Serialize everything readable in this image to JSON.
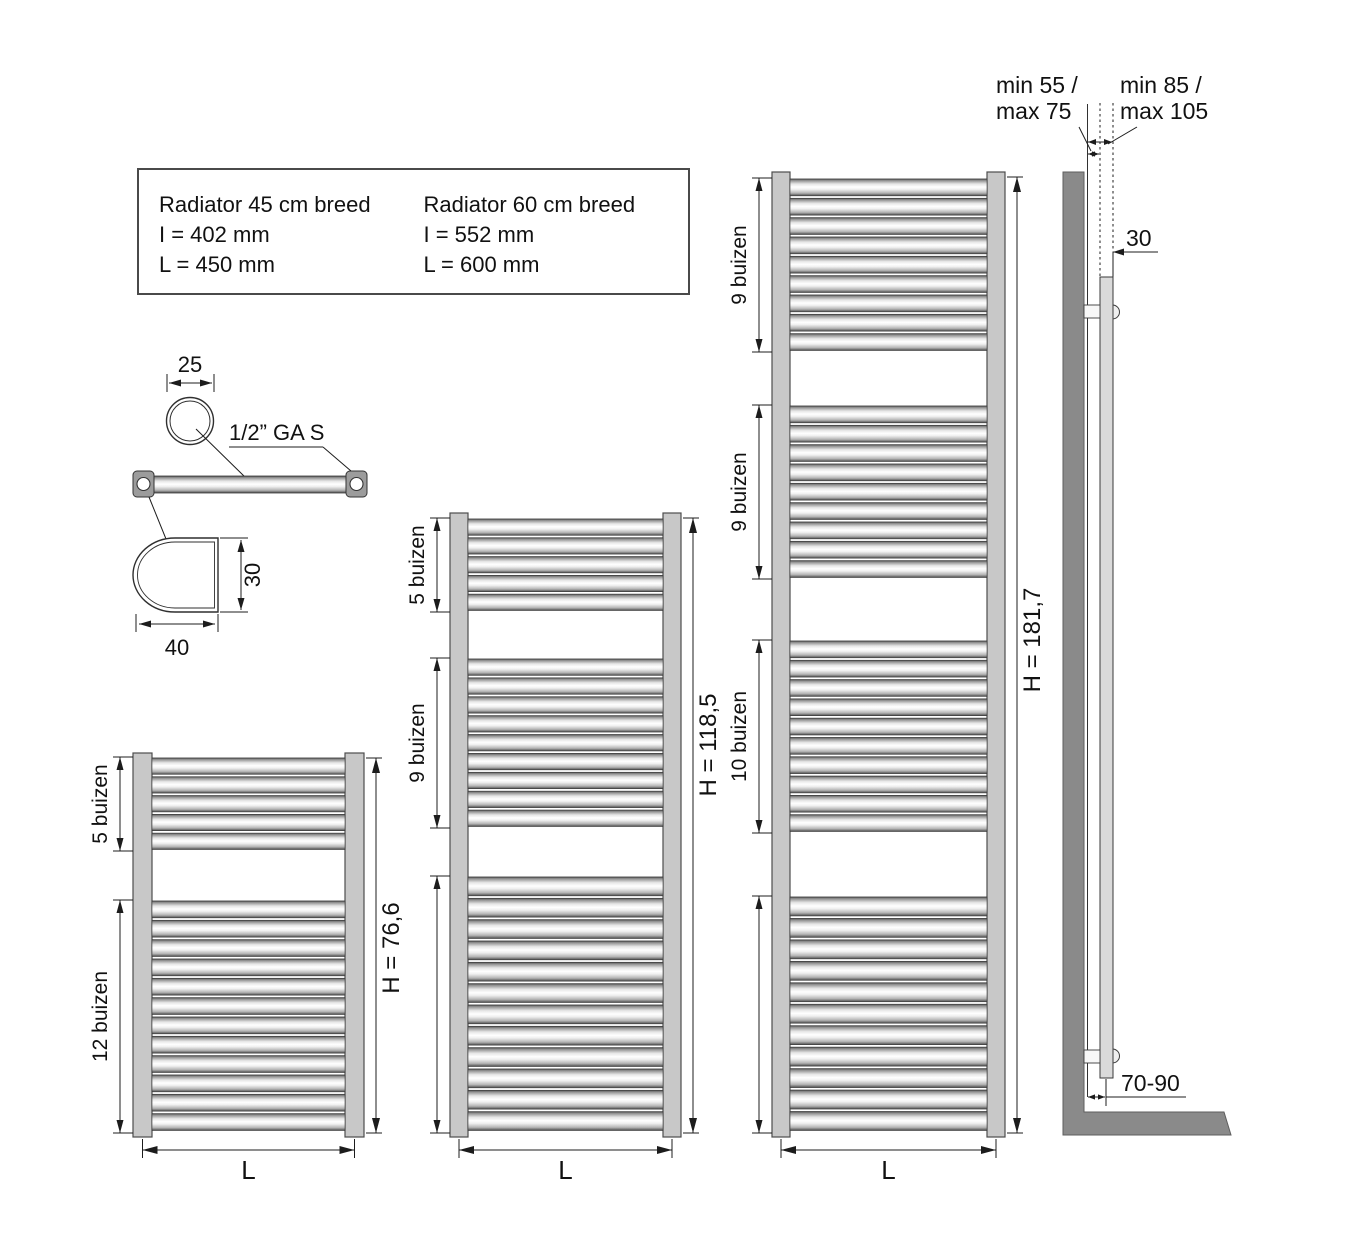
{
  "page": {
    "width": 1350,
    "height": 1237,
    "background": "#ffffff"
  },
  "info_box": {
    "columns": [
      {
        "title": "Radiator 45 cm breed",
        "line1": "I = 402 mm",
        "line2": "L = 450 mm"
      },
      {
        "title": "Radiator 60 cm breed",
        "line1": "I = 552 mm",
        "line2": "L = 600 mm"
      }
    ]
  },
  "detail_view": {
    "tube_diameter": "25",
    "connection": "1/2” GA S",
    "bracket_depth": "30",
    "bracket_width": "40"
  },
  "radiators": [
    {
      "id": "radiator-h766",
      "h_label": "H = 76,6",
      "h_label_cy": 948,
      "l_label": "L",
      "x_left": 133,
      "x_right": 364,
      "rail_w": 19,
      "y_top": 753,
      "groups": [
        {
          "label": "5 buizen",
          "count": 5,
          "y0": 757,
          "y1": 851
        },
        {
          "label": "12 buizen",
          "count": 12,
          "y0": 900,
          "y1": 1132,
          "arrow_y1": 1133
        }
      ]
    },
    {
      "id": "radiator-h1185",
      "h_label": "H = 118,5",
      "h_label_cy": 745,
      "l_label": "L",
      "x_left": 450,
      "x_right": 681,
      "rail_w": 18,
      "y_top": 513,
      "groups": [
        {
          "label": "5 buizen",
          "count": 5,
          "y0": 518,
          "y1": 612
        },
        {
          "label": "9 buizen",
          "count": 9,
          "y0": 658,
          "y1": 828
        },
        {
          "label": "",
          "count": 12,
          "y0": 876,
          "y1": 1132,
          "arrow_y1": 1133
        }
      ]
    },
    {
      "id": "radiator-h1817",
      "h_label": "H = 181,7",
      "h_label_cy": 640,
      "l_label": "L",
      "x_left": 772,
      "x_right": 1005,
      "rail_w": 18,
      "y_top": 172,
      "groups": [
        {
          "label": "9 buizen",
          "count": 9,
          "y0": 178,
          "y1": 352
        },
        {
          "label": "9 buizen",
          "count": 9,
          "y0": 405,
          "y1": 579
        },
        {
          "label": "10 buizen",
          "count": 10,
          "y0": 640,
          "y1": 833
        },
        {
          "label": "",
          "count": 11,
          "y0": 896,
          "y1": 1132,
          "arrow_y1": 1133
        }
      ]
    }
  ],
  "side_view": {
    "gap_line1": "min 55 /",
    "gap_line2": "max 75",
    "outer_line1": "min 85 /",
    "outer_line2": "max 105",
    "tube_depth": "30",
    "floor_distance": "70-90"
  },
  "colors": {
    "line": "#1c1c1c",
    "text": "#111111",
    "rail": "#c8c8c8",
    "rail_edge": "#4d4d4d",
    "wall": "#8a8a8a",
    "side_bar": "#dadada",
    "tube_edge": "#3a3a3a",
    "collar": "#9c9c9c"
  }
}
